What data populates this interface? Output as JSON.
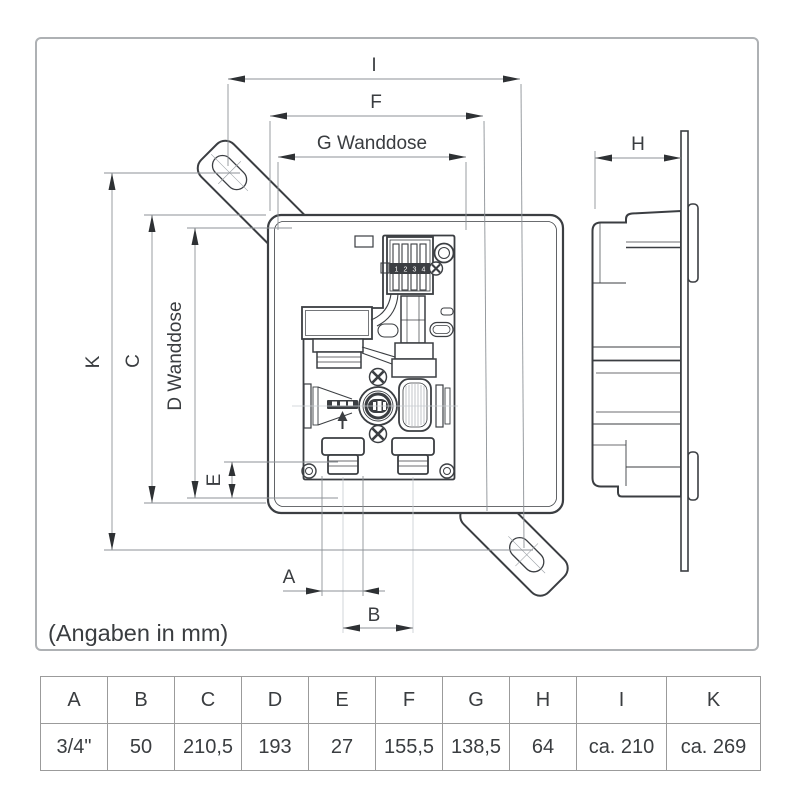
{
  "sheet": {
    "note": "(Angaben in mm)"
  },
  "dims": {
    "A": "A",
    "B": "B",
    "C": "C",
    "D": "D Wanddose",
    "E": "E",
    "F": "F",
    "G": "G Wanddose",
    "H": "H",
    "I": "I",
    "K": "K"
  },
  "terminal": {
    "numbers": [
      "1",
      "2",
      "3",
      "4"
    ]
  },
  "table": {
    "headers": [
      "A",
      "B",
      "C",
      "D",
      "E",
      "F",
      "G",
      "H",
      "I",
      "K"
    ],
    "values": [
      "3/4\"",
      "50",
      "210,5",
      "193",
      "27",
      "155,5",
      "138,5",
      "64",
      "ca. 210",
      "ca. 269"
    ]
  },
  "colors": {
    "line": "#3b3e42",
    "dimension_line": "#8d9297",
    "guide_line": "#c7ccd1",
    "arrow": "#2e3134",
    "frame_border": "#aeb1b4",
    "table_border": "#9b9b9b"
  }
}
